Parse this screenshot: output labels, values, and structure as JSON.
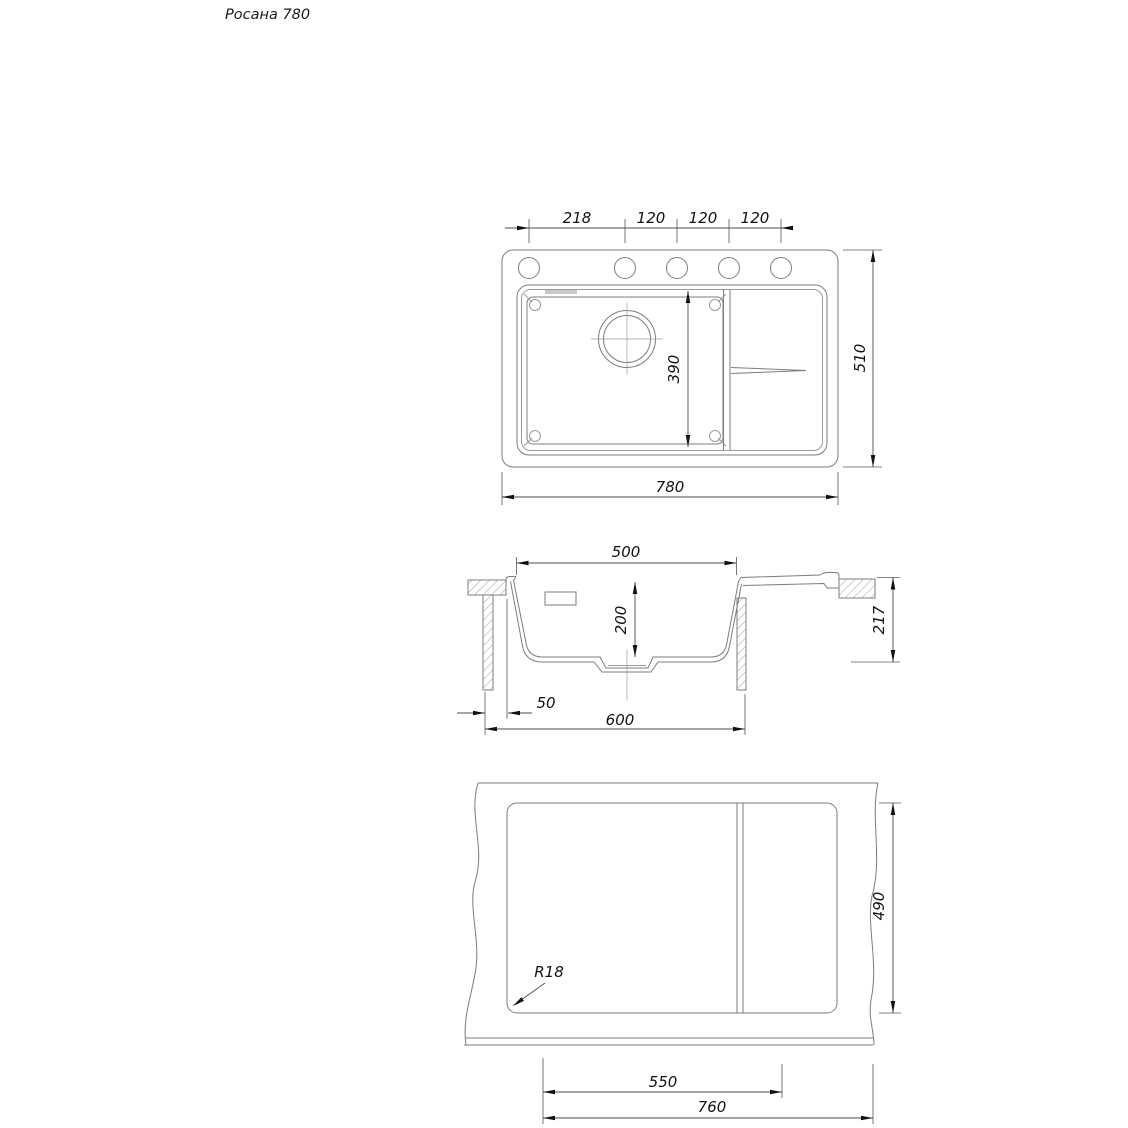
{
  "title": "Росана 780",
  "views": {
    "top": {
      "hole_spacing": [
        "218",
        "120",
        "120",
        "120"
      ],
      "bowl_length": "390",
      "overall_height": "510",
      "overall_width": "780"
    },
    "section": {
      "bowl_top_width": "500",
      "bowl_depth": "200",
      "total_height": "217",
      "edge_offset": "50",
      "cabinet_width": "600"
    },
    "cutout": {
      "cutout_height": "490",
      "corner_radius": "R18",
      "main_section_width": "550",
      "cutout_width": "760"
    }
  }
}
